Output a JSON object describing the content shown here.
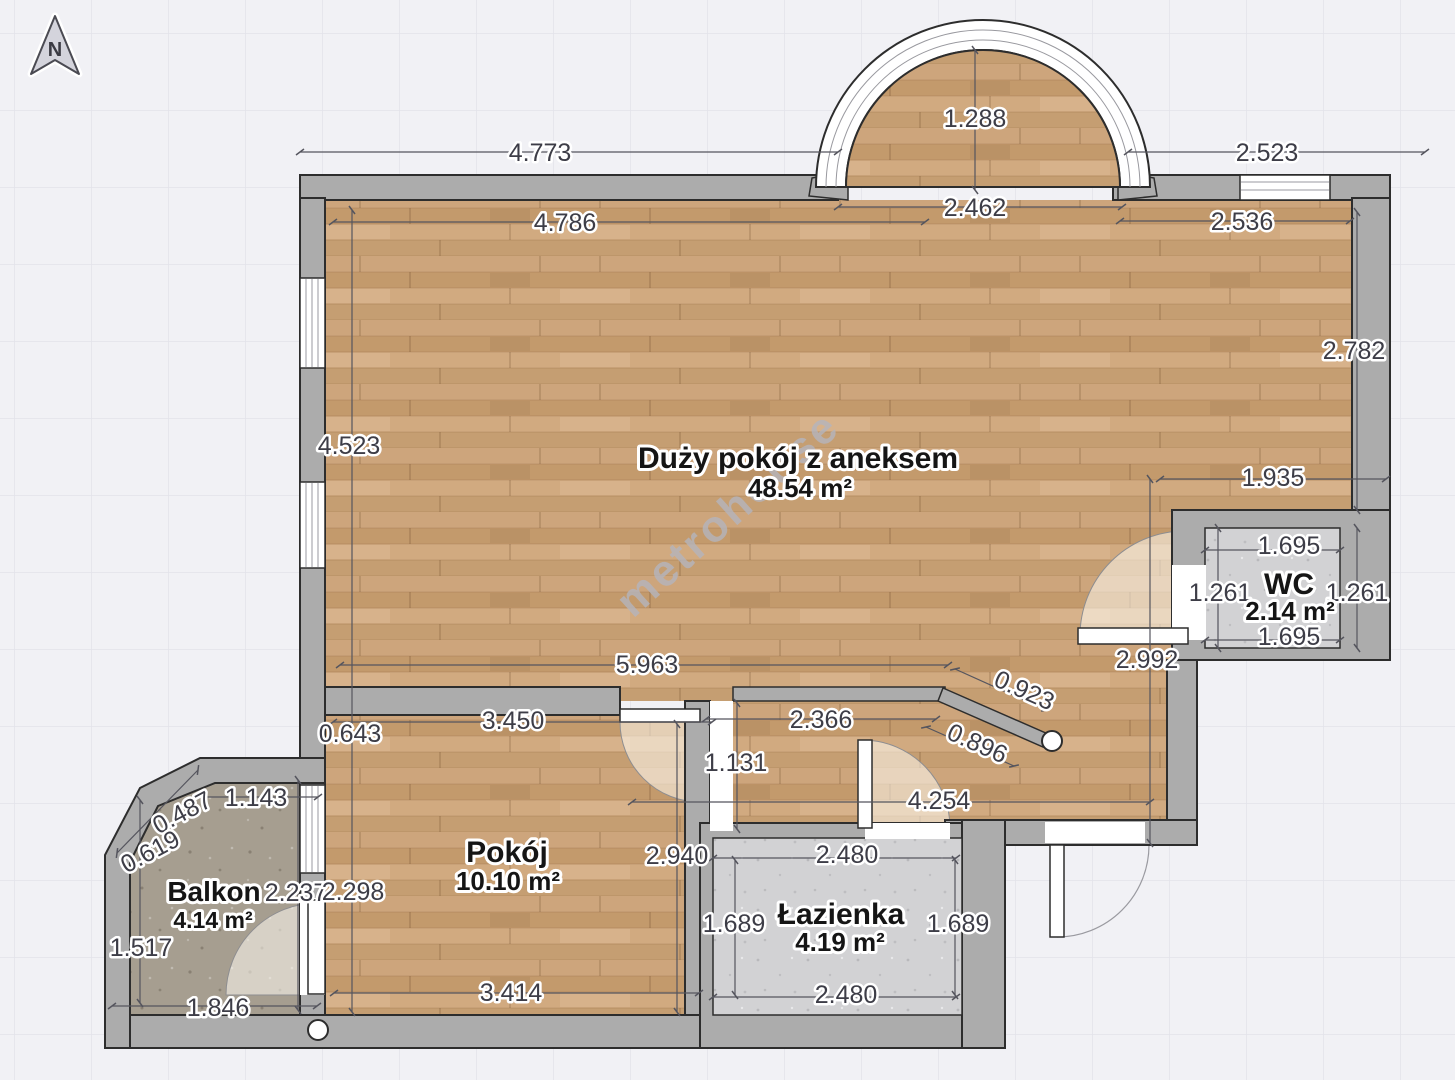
{
  "compass": {
    "label": "N"
  },
  "watermark": {
    "text": "metrohouse"
  },
  "rooms": {
    "living": {
      "name": "Duży pokój z aneksem",
      "area": "48.54 m²"
    },
    "wc": {
      "name": "WC",
      "area": "2.14 m²"
    },
    "room": {
      "name": "Pokój",
      "area": "10.10 m²"
    },
    "bathroom": {
      "name": "Łazienka",
      "area": "4.19 m²"
    },
    "balcony": {
      "name": "Balkon",
      "area": "4.14 m²"
    }
  },
  "dims": {
    "top_left_ext": "4.773",
    "top_right_ext": "2.523",
    "arch_depth": "1.288",
    "arch_width": "2.462",
    "living_top_w": "4.786",
    "living_top_e": "2.536",
    "right_wall": "2.782",
    "left_wall": "4.523",
    "wc_offset": "1.935",
    "wc_top": "1.695",
    "wc_left": "1.261",
    "wc_right": "1.261",
    "wc_bottom": "1.695",
    "hall_h": "2.992",
    "living_bottom": "5.963",
    "diag_a": "0.923",
    "diag_b": "0.896",
    "corridor_w": "2.366",
    "corridor_h": "1.131",
    "room_offset": "0.643",
    "room_top": "3.450",
    "hall_w": "4.254",
    "room_h": "2.940",
    "balc_cham_a": "0.487",
    "balc_top": "1.143",
    "balc_cham_b": "0.619",
    "balc_h": "2.237",
    "room_left_h": "2.298",
    "balc_left": "1.517",
    "bath_top": "2.480",
    "bath_left": "1.689",
    "bath_right": "1.689",
    "bath_bottom": "2.480",
    "room_bottom": "3.414",
    "balc_bottom": "1.846"
  },
  "colors": {
    "background": "#f1f1f5",
    "grid_line": "#e2e2ea",
    "wall": "#acacac",
    "outline": "#2d2d2d",
    "wood": "#c9a176",
    "tile": "#d2d2d4",
    "concrete": "#a69e90",
    "dimension": "#55555e"
  }
}
